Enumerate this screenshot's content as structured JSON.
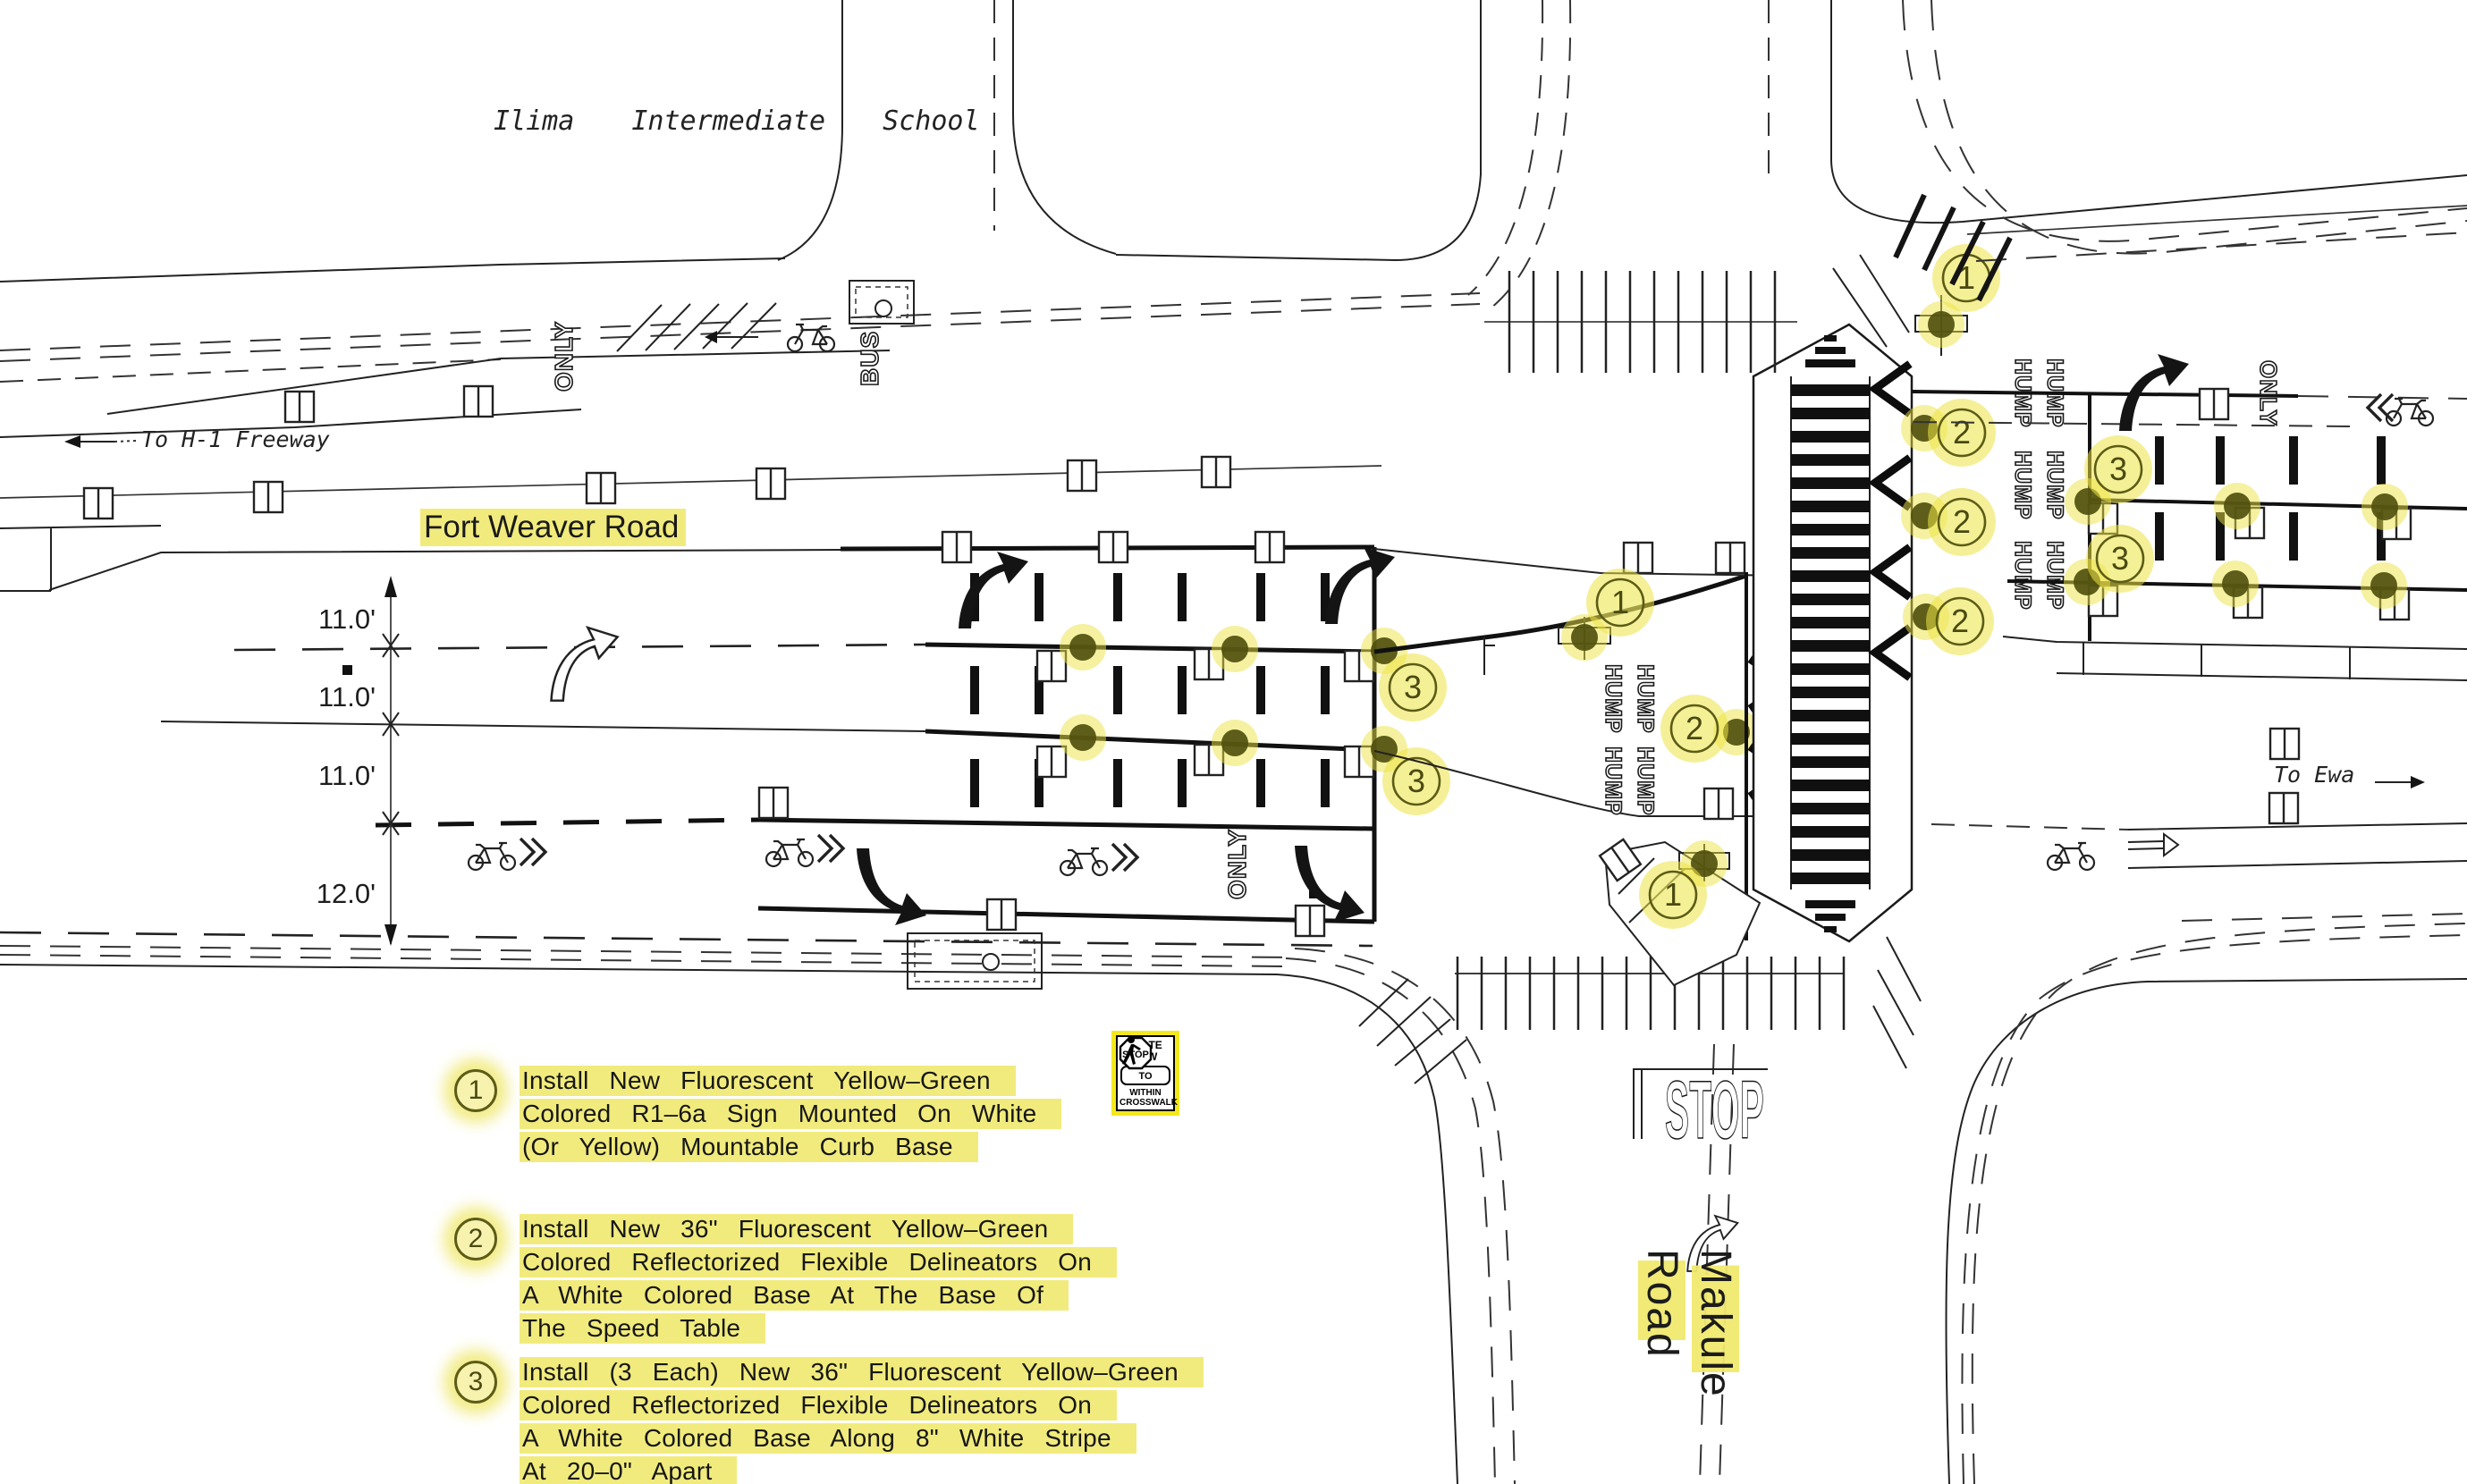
{
  "labels": {
    "school": "Ilima Intermediate School",
    "to_h1": "To H-1 Freeway",
    "fort_weaver": "Fort Weaver Road",
    "to_ewa": "To Ewa",
    "makule_line1": "Makule",
    "makule_line2": "Road"
  },
  "dims": [
    "11.0'",
    "11.0'",
    "11.0'",
    "12.0'"
  ],
  "pavement": {
    "bus": "BUS",
    "only": "ONLY",
    "hump": "HUMP",
    "stop": "STOP"
  },
  "sign": {
    "state_law": "STATE LAW",
    "stop": "STOP",
    "to": "TO",
    "within": "WITHIN",
    "crosswalk": "CROSSWALK"
  },
  "callouts": {
    "one": "1",
    "two": "2",
    "three": "3"
  },
  "notes": [
    {
      "num": "1",
      "lines": [
        "Install New Fluorescent Yellow–Green",
        "Colored R1–6a Sign Mounted On White",
        "(Or Yellow) Mountable Curb Base"
      ]
    },
    {
      "num": "2",
      "lines": [
        "Install New 36\" Fluorescent Yellow–Green",
        "Colored Reflectorized Flexible Delineators On",
        "A White Colored Base At The Base Of",
        "The Speed Table"
      ]
    },
    {
      "num": "3",
      "lines": [
        "Install (3 Each) New 36\" Fluorescent Yellow–Green",
        "Colored Reflectorized Flexible Delineators On",
        "A White Colored Base Along 8\" White Stripe",
        "At 20–0\" Apart"
      ]
    }
  ],
  "colors": {
    "highlight": "#f1eb7d",
    "halo": "#ece343",
    "ink": "#1a1a1a",
    "olive": "#50500e"
  }
}
